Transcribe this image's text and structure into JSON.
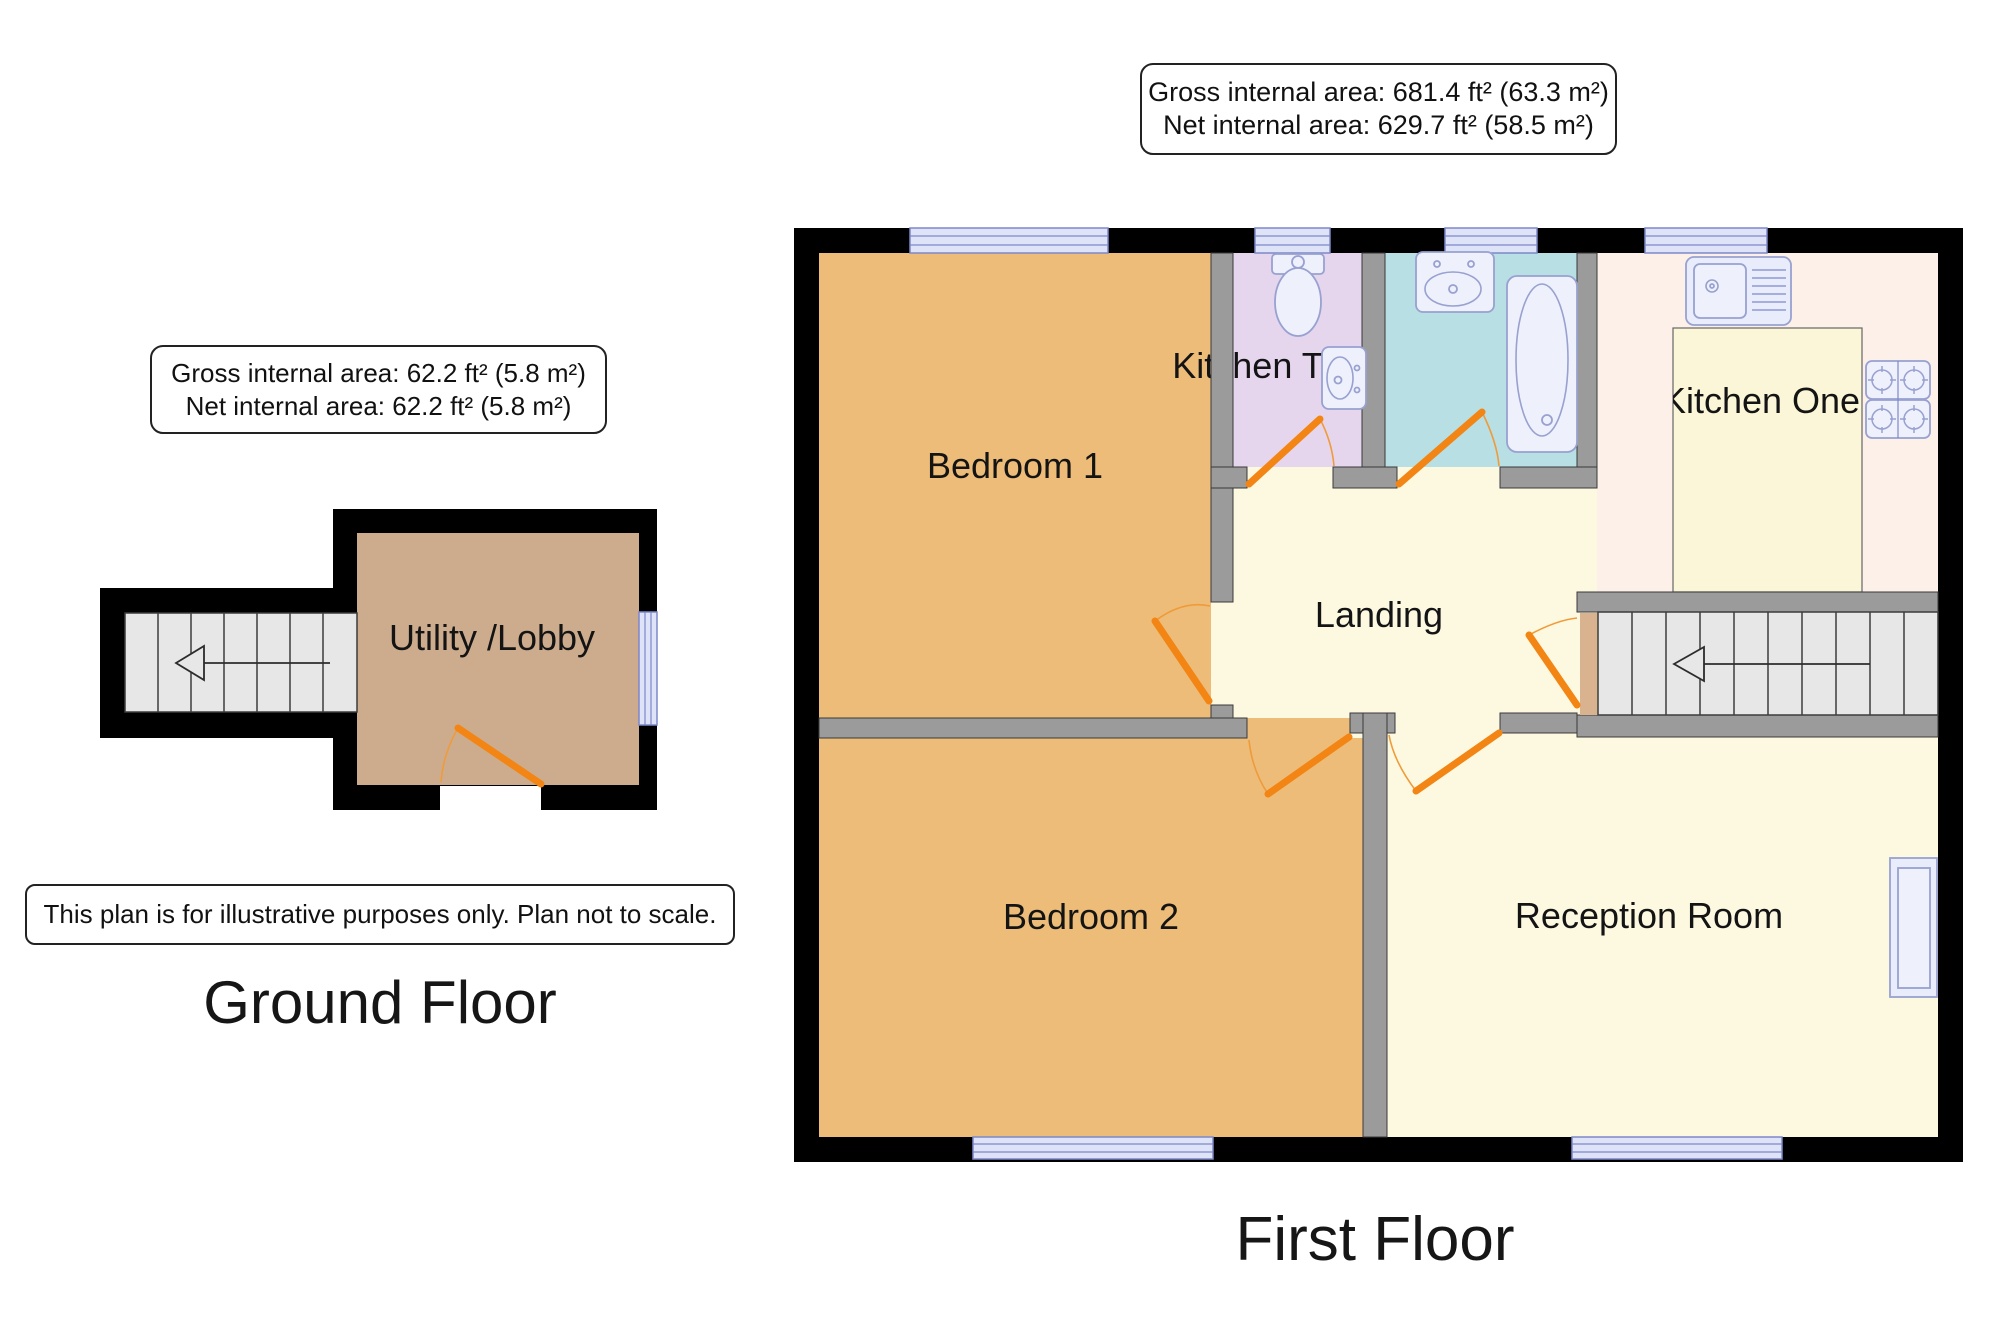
{
  "page": {
    "width": 2000,
    "height": 1333,
    "background": "#ffffff"
  },
  "ground_floor": {
    "title": "Ground Floor",
    "info_box": {
      "line1": "Gross internal area: 62.2 ft² (5.8 m²)",
      "line2": "Net internal area: 62.2 ft² (5.8 m²)"
    },
    "disclaimer": "This plan is for illustrative purposes only. Plan not to scale.",
    "rooms": [
      {
        "label": "Utility /Lobby"
      }
    ]
  },
  "first_floor": {
    "title": "First Floor",
    "info_box": {
      "line1": "Gross internal area: 681.4 ft² (63.3 m²)",
      "line2": "Net internal area: 629.7 ft² (58.5 m²)"
    },
    "rooms": [
      {
        "label": "Bedroom 1"
      },
      {
        "label": "Bedroom 2"
      },
      {
        "label": "Kitchen Two"
      },
      {
        "label": "Kitchen One"
      },
      {
        "label": "Landing"
      },
      {
        "label": "Reception Room"
      }
    ]
  },
  "icons": {
    "toilet-icon": "wc toilet with cistern",
    "corner-basin-icon": "small corner hand basin",
    "basin-icon": "bathroom wash basin",
    "bath-icon": "bathtub",
    "kitchen-sink-icon": "sink with drainer",
    "hob-icon": "4-ring cooker hob",
    "stairs-up-arrow-icon": "stair direction arrow pointing left"
  },
  "colors": {
    "outer_wall": "#000000",
    "inner_wall": "#9b9b9b",
    "bedroom_fill": "#edbc79",
    "landing_fill": "#fdf9e1",
    "kitchen_fill": "#fcf0e9",
    "kitchen_island_fill": "#fbf6d7",
    "wc_fill": "#e5d6ee",
    "bath_fill": "#b8dfe3",
    "utility_fill": "#cdac8e",
    "stair_tread": "#e7e7e7",
    "stair_threshold": "#d9b28f",
    "window_glass": "#dfe3f8",
    "fixture_fill": "#eef0fb",
    "door": "#f28513",
    "text": "#141414"
  }
}
